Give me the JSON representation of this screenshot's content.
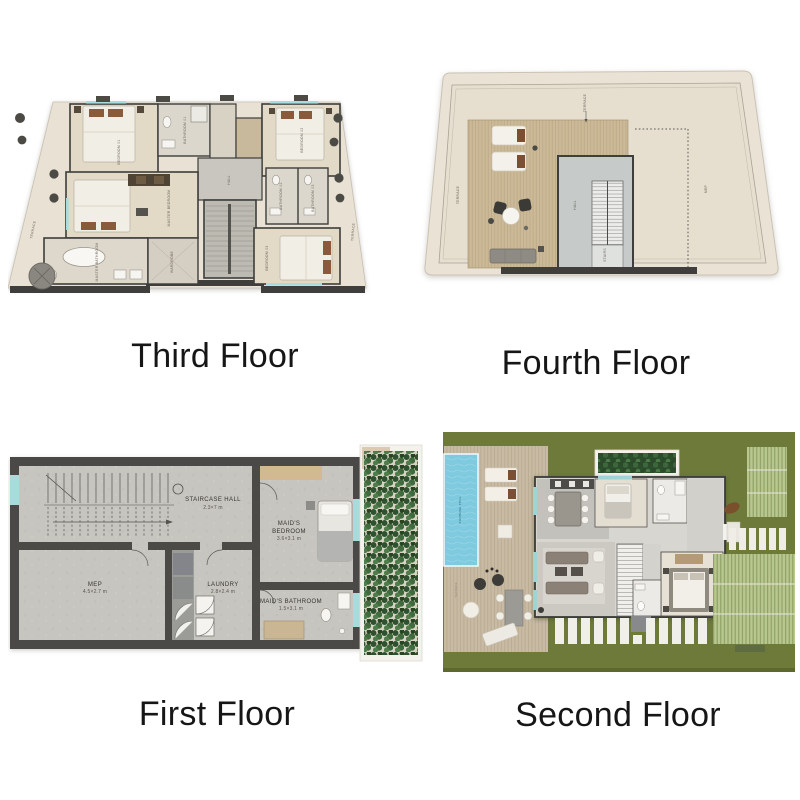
{
  "page": {
    "background": "#ffffff"
  },
  "floors": {
    "third": {
      "title": "Third Floor",
      "labels": {
        "bedroom1": "BEDROOM 01",
        "bathroom1": "BATHROOM 01",
        "bedroom2": "BEDROOM 02",
        "hall": "HALL",
        "master_bedroom": "MASTER BEDROOM",
        "master_bathroom": "MASTER BATHROOM",
        "wardrobe": "WARDROBE",
        "bathroom2": "BATHROOM 02",
        "bathroom3": "BATHROOM 03",
        "bedroom3": "BEDROOM 03",
        "terrace_left": "TERRACE",
        "terrace_right": "TERRACE"
      }
    },
    "fourth": {
      "title": "Fourth Floor",
      "labels": {
        "terrace_top": "TERRACE",
        "terrace_left": "TERRACE",
        "hall": "HALL",
        "stairs": "STAIRS",
        "mep": "MEP"
      }
    },
    "first": {
      "title": "First Floor",
      "staircase_hall": {
        "name": "STAIRCASE HALL",
        "dims": "2.3×7 m"
      },
      "mep": {
        "name": "MEP",
        "dims": "4.5×2.7 m"
      },
      "laundry": {
        "name": "LAUNDRY",
        "dims": "2.8×2.4 m"
      },
      "maids_bedroom": {
        "line1": "MAID'S",
        "line2": "BEDROOM",
        "dims": "3.6×3.1 m"
      },
      "maids_bathroom": {
        "name": "MAID'S BATHROOM",
        "dims": "1.5×3.1 m"
      }
    },
    "second": {
      "title": "Second Floor",
      "labels": {
        "pool": "SWIMMING POOL",
        "terrace": "TERRACE"
      }
    }
  },
  "colors": {
    "terrace_beige": "#e9e2d4",
    "wood_floor": "#e2d9c6",
    "wall_dark": "#44423e",
    "concrete": "#c7c5bf",
    "stair_gray": "#bdbab2",
    "deck_tan": "#cbb997",
    "pool_blue": "#7fcade",
    "lawn_green": "#6d7a3a",
    "hedge_green": "#b9c68f",
    "leaf_green": "#2e5230",
    "title_text": "#161616"
  }
}
